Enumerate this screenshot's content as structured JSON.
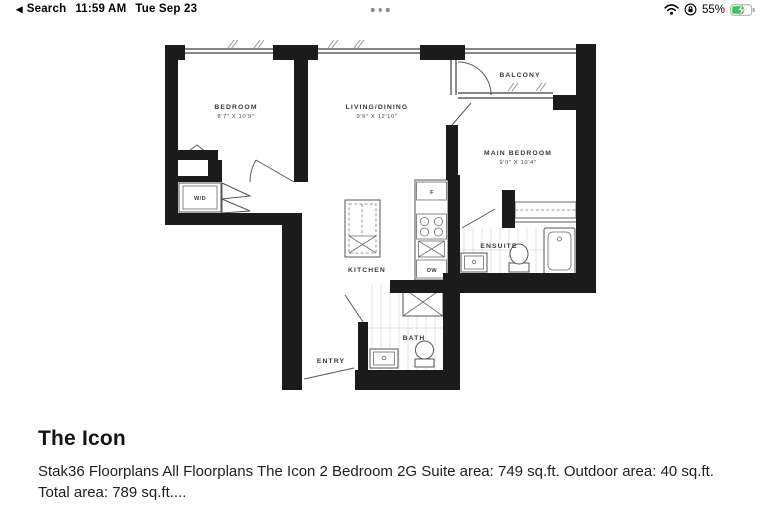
{
  "status_bar": {
    "back_label": "Search",
    "time": "11:59 AM",
    "date": "Tue Sep 23",
    "battery_percent": "55%",
    "battery_color": "#34c759",
    "icons": {
      "back": "◀",
      "wifi": "wifi-icon",
      "rotation_lock": "orientation-lock-icon",
      "battery": "battery-charging-icon",
      "multitask": "three-dots-indicator"
    }
  },
  "floorplan": {
    "bedroom": {
      "label": "BEDROOM",
      "dims": "8'7\" X 10'5\""
    },
    "living_dining": {
      "label": "LIVING/DINING",
      "dims": "9'9\" X 12'10\""
    },
    "balcony": {
      "label": "BALCONY"
    },
    "main_bedroom": {
      "label": "MAIN BEDROOM",
      "dims": "9'0\" X 10'4\""
    },
    "kitchen": {
      "label": "KITCHEN"
    },
    "ensuite": {
      "label": "ENSUITE"
    },
    "bath": {
      "label": "BATH"
    },
    "entry": {
      "label": "ENTRY"
    },
    "washer_dryer": {
      "label": "W/D"
    },
    "fridge": {
      "label": "F"
    },
    "dishwasher": {
      "label": "DW"
    }
  },
  "details": {
    "title": "The Icon",
    "description": "Stak36 Floorplans All Floorplans The Icon 2 Bedroom 2G Suite area: 749 sq.ft. Outdoor area: 40 sq.ft. Total area: 789 sq.ft...."
  }
}
